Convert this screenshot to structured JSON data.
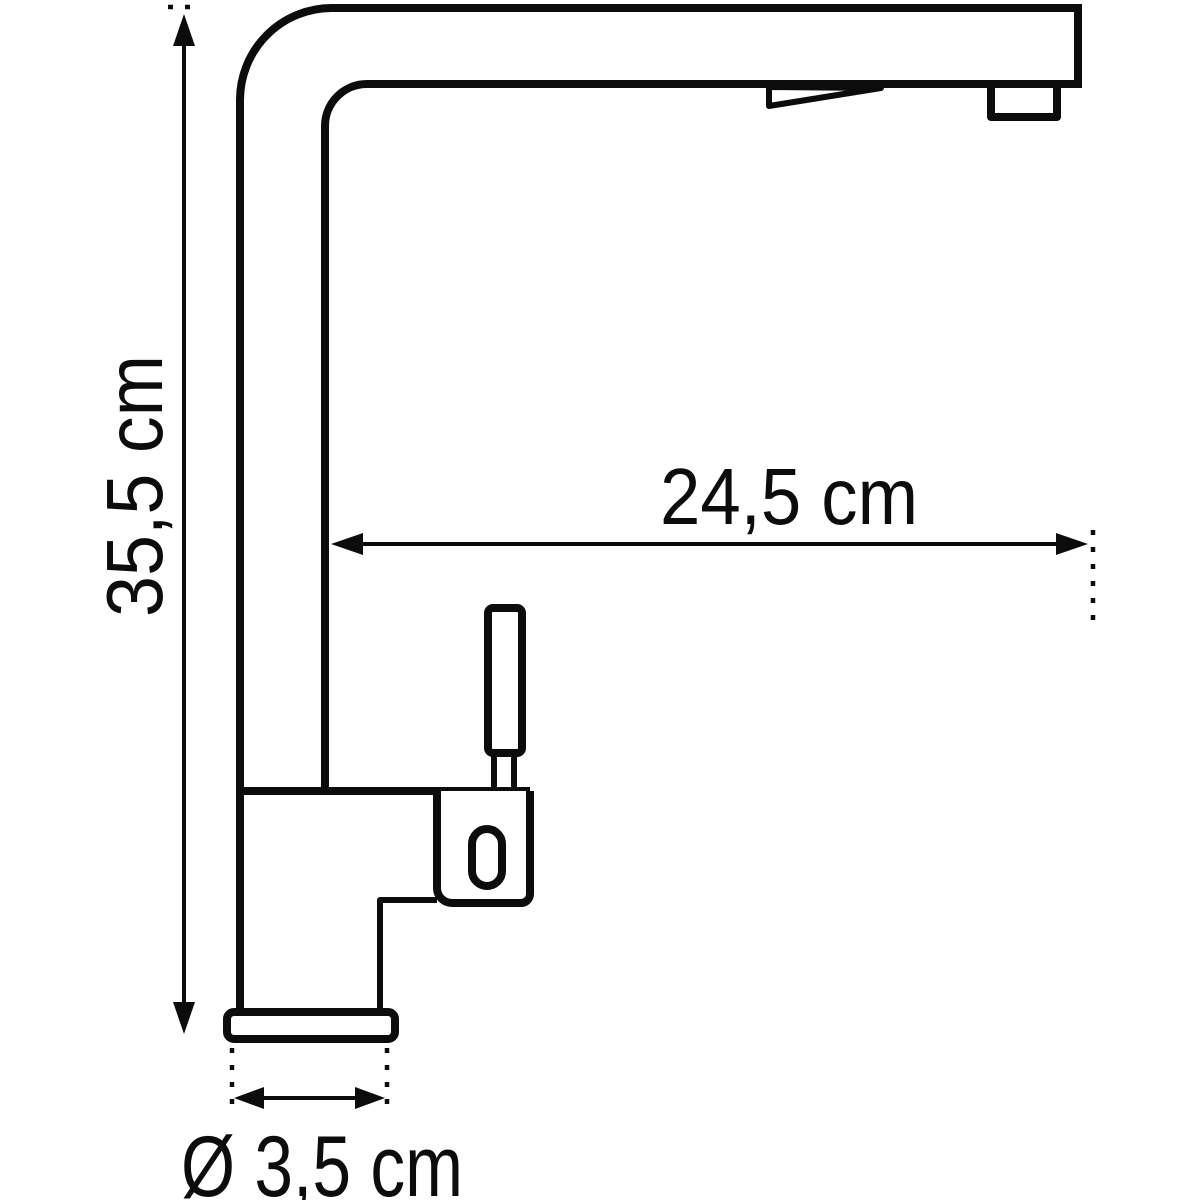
{
  "diagram": {
    "subject": "kitchen-faucet-side-view-technical-drawing",
    "colors": {
      "line": "#0c0c0c",
      "background": "#ffffff"
    },
    "annotations": {
      "height": {
        "label": "35,5 cm",
        "value": "35,5",
        "unit": "cm"
      },
      "reach": {
        "label": "24,5 cm",
        "value": "24,5",
        "unit": "cm"
      },
      "base_diameter": {
        "label": "Ø 3,5 cm",
        "value": "3,5",
        "unit": "cm",
        "symbol": "Ø"
      }
    }
  }
}
